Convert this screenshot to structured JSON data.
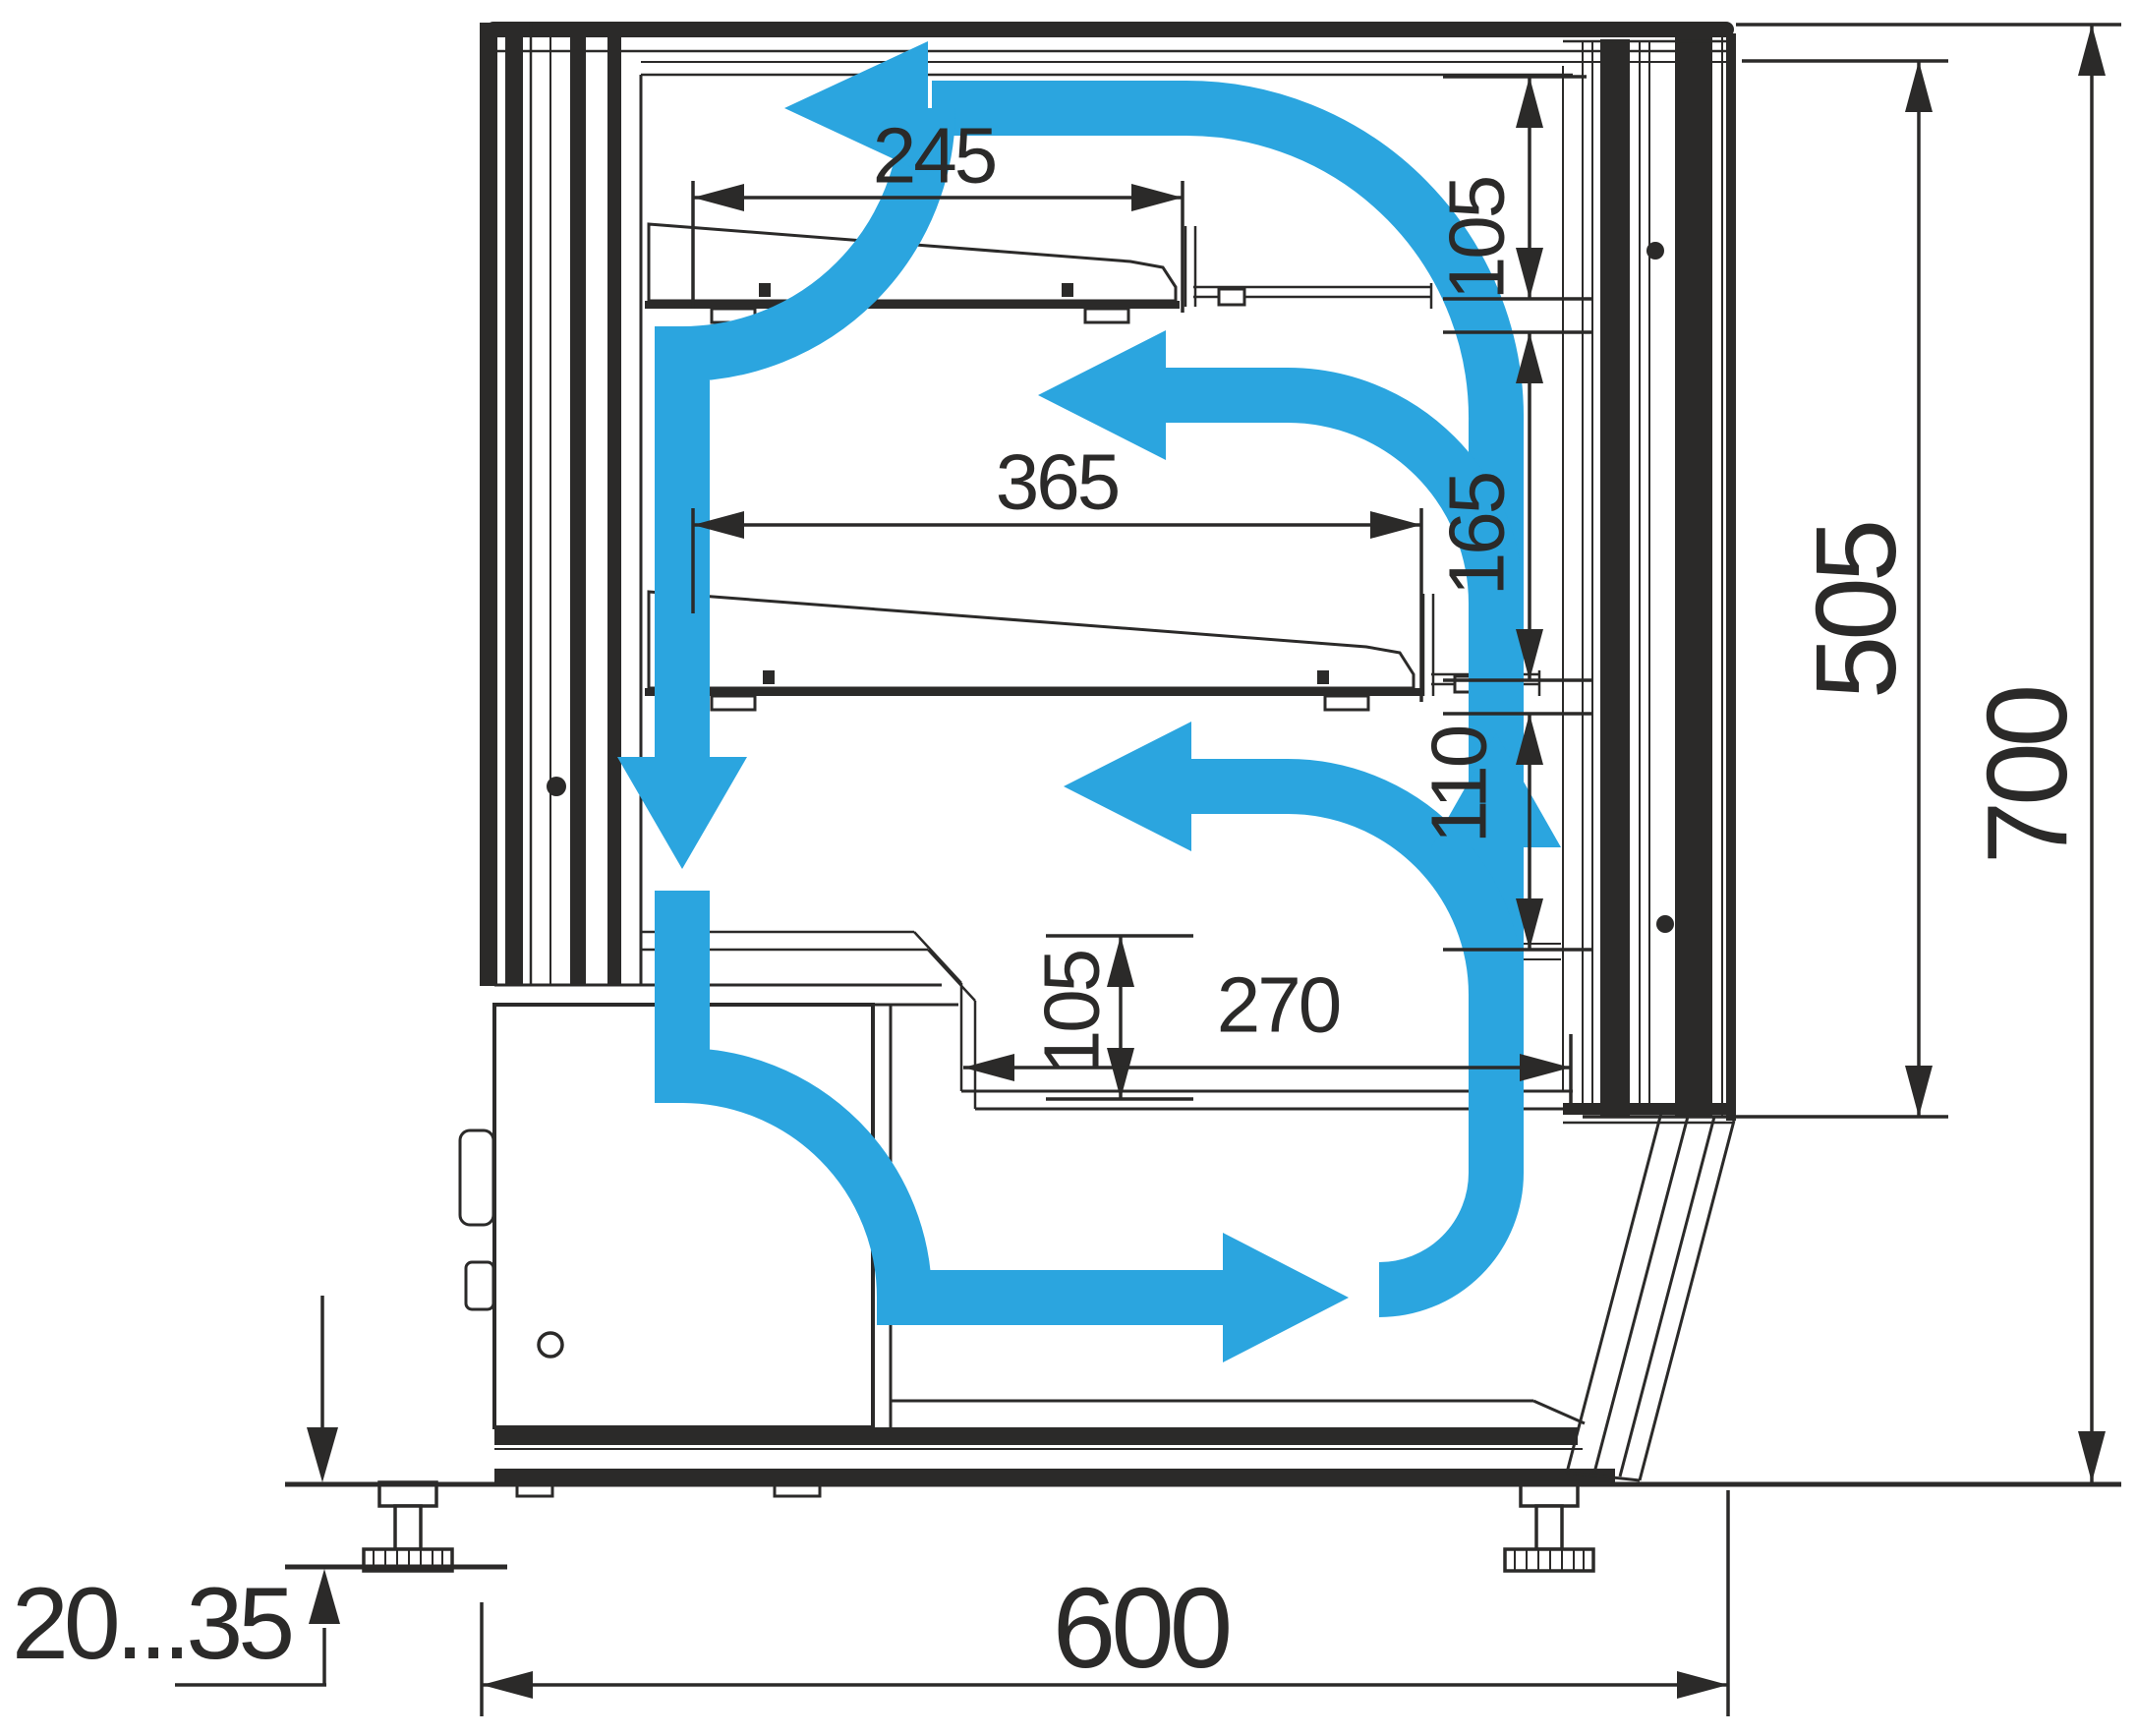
{
  "drawing": {
    "type": "refrigerated-display-case-cross-section",
    "colors": {
      "line": "#2b2a29",
      "airflow": "#2ba5df",
      "background": "#ffffff"
    }
  },
  "dims": {
    "shelf_upper_depth": {
      "value": "245"
    },
    "shelf_lower_depth": {
      "value": "365"
    },
    "clearance_top": {
      "value": "105"
    },
    "clearance_middle": {
      "value": "165"
    },
    "clearance_lower": {
      "value": "110"
    },
    "well_depth": {
      "value": "105"
    },
    "well_length": {
      "value": "270"
    },
    "glass_opening_height": {
      "value": "505"
    },
    "overall_height": {
      "value": "700"
    },
    "overall_depth": {
      "value": "600"
    },
    "leg_adjustment_range": {
      "value": "20...35"
    }
  }
}
